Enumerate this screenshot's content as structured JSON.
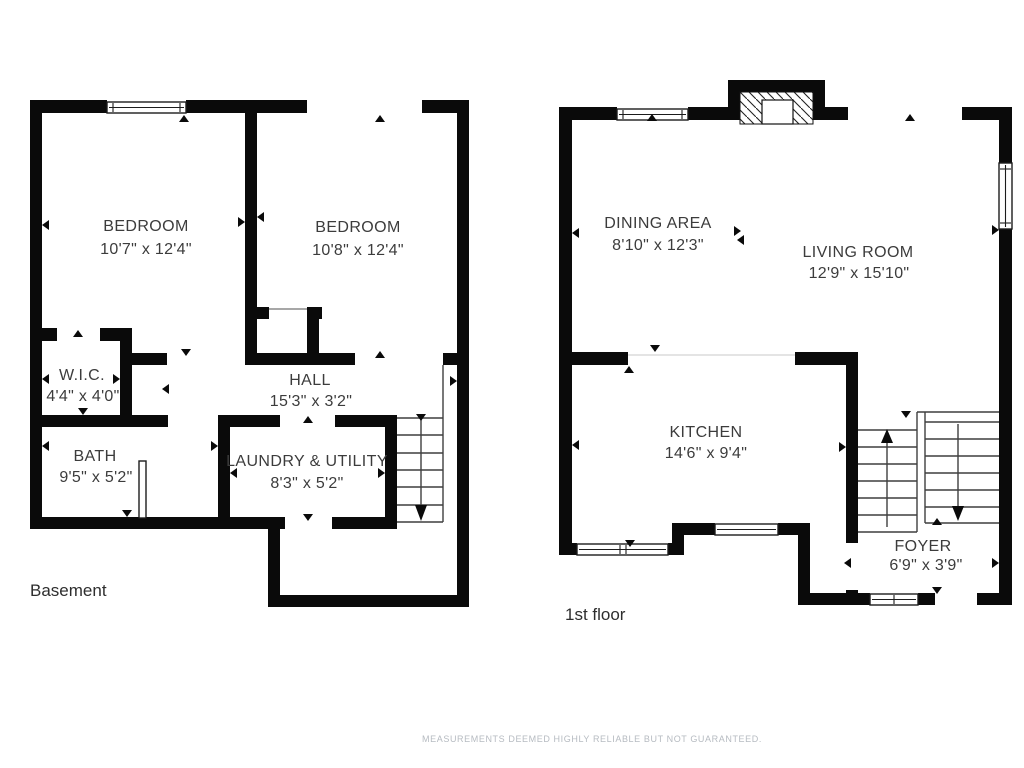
{
  "disclaimer": "MEASUREMENTS DEEMED HIGHLY RELIABLE BUT NOT GUARANTEED.",
  "colors": {
    "wall": "#0a0a0a",
    "label": "#3c3c3c",
    "disclaimer": "#b6bbc1",
    "background": "#ffffff"
  },
  "floorplans": [
    {
      "title": "Basement",
      "rooms": [
        {
          "name": "BEDROOM",
          "dims": "10'7\" x 12'4\""
        },
        {
          "name": "BEDROOM",
          "dims": "10'8\" x 12'4\""
        },
        {
          "name": "W.I.C.",
          "dims": "4'4\" x 4'0\""
        },
        {
          "name": "HALL",
          "dims": "15'3\" x 3'2\""
        },
        {
          "name": "BATH",
          "dims": "9'5\" x 5'2\""
        },
        {
          "name": "LAUNDRY & UTILITY",
          "dims": "8'3\" x 5'2\""
        }
      ]
    },
    {
      "title": "1st floor",
      "rooms": [
        {
          "name": "DINING AREA",
          "dims": "8'10\" x 12'3\""
        },
        {
          "name": "LIVING ROOM",
          "dims": "12'9\" x 15'10\""
        },
        {
          "name": "KITCHEN",
          "dims": "14'6\" x 9'4\""
        },
        {
          "name": "FOYER",
          "dims": "6'9\" x 3'9\""
        }
      ]
    }
  ]
}
